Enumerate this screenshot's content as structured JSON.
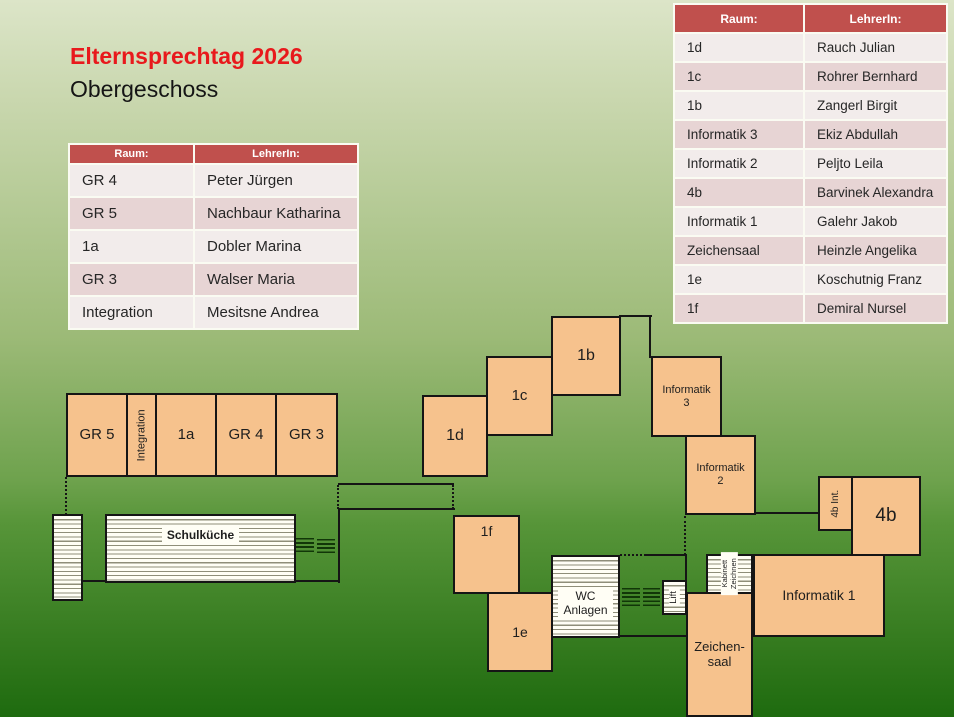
{
  "header": {
    "title": "Elternsprechtag 2026",
    "subtitle": "Obergeschoss"
  },
  "tables": {
    "left": {
      "headers": {
        "room": "Raum:",
        "teacher": "LehrerIn:"
      },
      "rows": [
        {
          "room": "GR 4",
          "teacher": "Peter Jürgen"
        },
        {
          "room": "GR 5",
          "teacher": "Nachbaur Katharina"
        },
        {
          "room": "1a",
          "teacher": "Dobler Marina"
        },
        {
          "room": "GR 3",
          "teacher": "Walser Maria"
        },
        {
          "room": "Integration",
          "teacher": "Mesitsne Andrea"
        }
      ]
    },
    "right": {
      "headers": {
        "room": "Raum:",
        "teacher": "LehrerIn:"
      },
      "rows": [
        {
          "room": "1d",
          "teacher": "Rauch Julian"
        },
        {
          "room": "1c",
          "teacher": "Rohrer Bernhard"
        },
        {
          "room": "1b",
          "teacher": "Zangerl Birgit"
        },
        {
          "room": "Informatik 3",
          "teacher": "Ekiz Abdullah"
        },
        {
          "room": "Informatik 2",
          "teacher": "Peljto Leila"
        },
        {
          "room": "4b",
          "teacher": "Barvinek Alexandra"
        },
        {
          "room": "Informatik 1",
          "teacher": "Galehr Jakob"
        },
        {
          "room": "Zeichensaal",
          "teacher": "Heinzle Angelika"
        },
        {
          "room": "1e",
          "teacher": "Koschutnig Franz"
        },
        {
          "room": "1f",
          "teacher": "Demiral Nursel"
        }
      ]
    }
  },
  "floorplan": {
    "rooms": [
      {
        "id": "gr5",
        "label": "GR 5"
      },
      {
        "id": "integration",
        "label": "Integration"
      },
      {
        "id": "1a",
        "label": "1a"
      },
      {
        "id": "gr4",
        "label": "GR 4"
      },
      {
        "id": "gr3",
        "label": "GR 3"
      },
      {
        "id": "1d",
        "label": "1d"
      },
      {
        "id": "1c",
        "label": "1c"
      },
      {
        "id": "1b",
        "label": "1b"
      },
      {
        "id": "informatik3",
        "label": "Informatik\n3"
      },
      {
        "id": "informatik2",
        "label": "Informatik\n2"
      },
      {
        "id": "4b-int",
        "label": "4b Int."
      },
      {
        "id": "4b",
        "label": "4b"
      },
      {
        "id": "informatik1",
        "label": "Informatik 1"
      },
      {
        "id": "zeichensaal",
        "label": "Zeichen-\nsaal"
      },
      {
        "id": "1f",
        "label": "1f"
      },
      {
        "id": "1e",
        "label": "1e"
      },
      {
        "id": "schulkueche",
        "label": "Schulküche"
      },
      {
        "id": "wc",
        "label": "WC\nAnlagen"
      },
      {
        "id": "lift",
        "label": "Lift"
      },
      {
        "id": "kabinett",
        "label": "Kabinett\nZeichnen"
      }
    ]
  },
  "colors": {
    "table_header": "#c0504d",
    "row_dark": "#e7d4d4",
    "row_light": "#f2eceb",
    "room_fill": "#f6c28d",
    "title_red": "#e8191c"
  }
}
